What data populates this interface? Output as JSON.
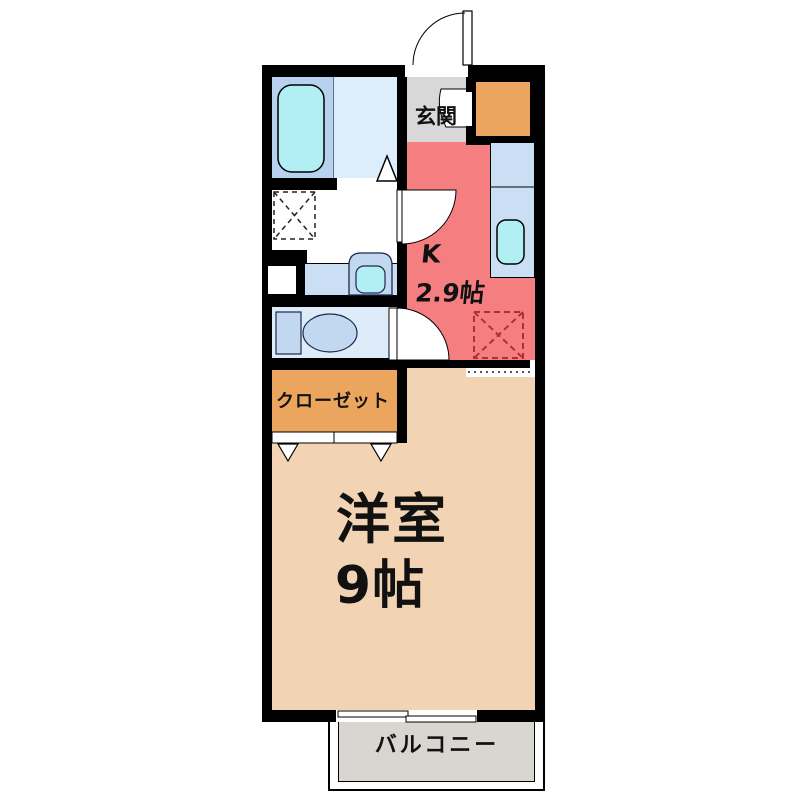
{
  "floorplan": {
    "type": "apartment-floor-plan-1K",
    "labels": {
      "genkan": "玄関",
      "kitchen_k": "K",
      "kitchen_size": "2.9帖",
      "closet": "クローゼット",
      "room_name": "洋室",
      "room_size": "9帖",
      "balcony": "バルコニー"
    },
    "fixtures": [
      "entrance-door-swing",
      "shoe-storage",
      "bathtub",
      "bathroom-door-marker",
      "washing-machine-space",
      "washbasin",
      "toilet",
      "kitchen-counter",
      "kitchen-sink",
      "refrigerator-space",
      "closet-folding-doors",
      "sliding-window",
      "balcony-deck"
    ],
    "colors": {
      "wall": "#000000",
      "kitchen": "#F57F80",
      "room": "#F2D4B4",
      "closet": "#ECA55E",
      "shoe_box": "#ECA55E",
      "genkan": "#D8D8D8",
      "balcony": "#D9D5D0",
      "bath_floor": "#B7D2EF",
      "bath_floor_light": "#DEEDFB",
      "toilet_floor": "#DEEBF9",
      "fixture_blue": "#C2D8F0",
      "water_cyan": "#B2EFF5",
      "counter_blue": "#CBDFF4",
      "fridge_dash": "#B03030"
    }
  }
}
